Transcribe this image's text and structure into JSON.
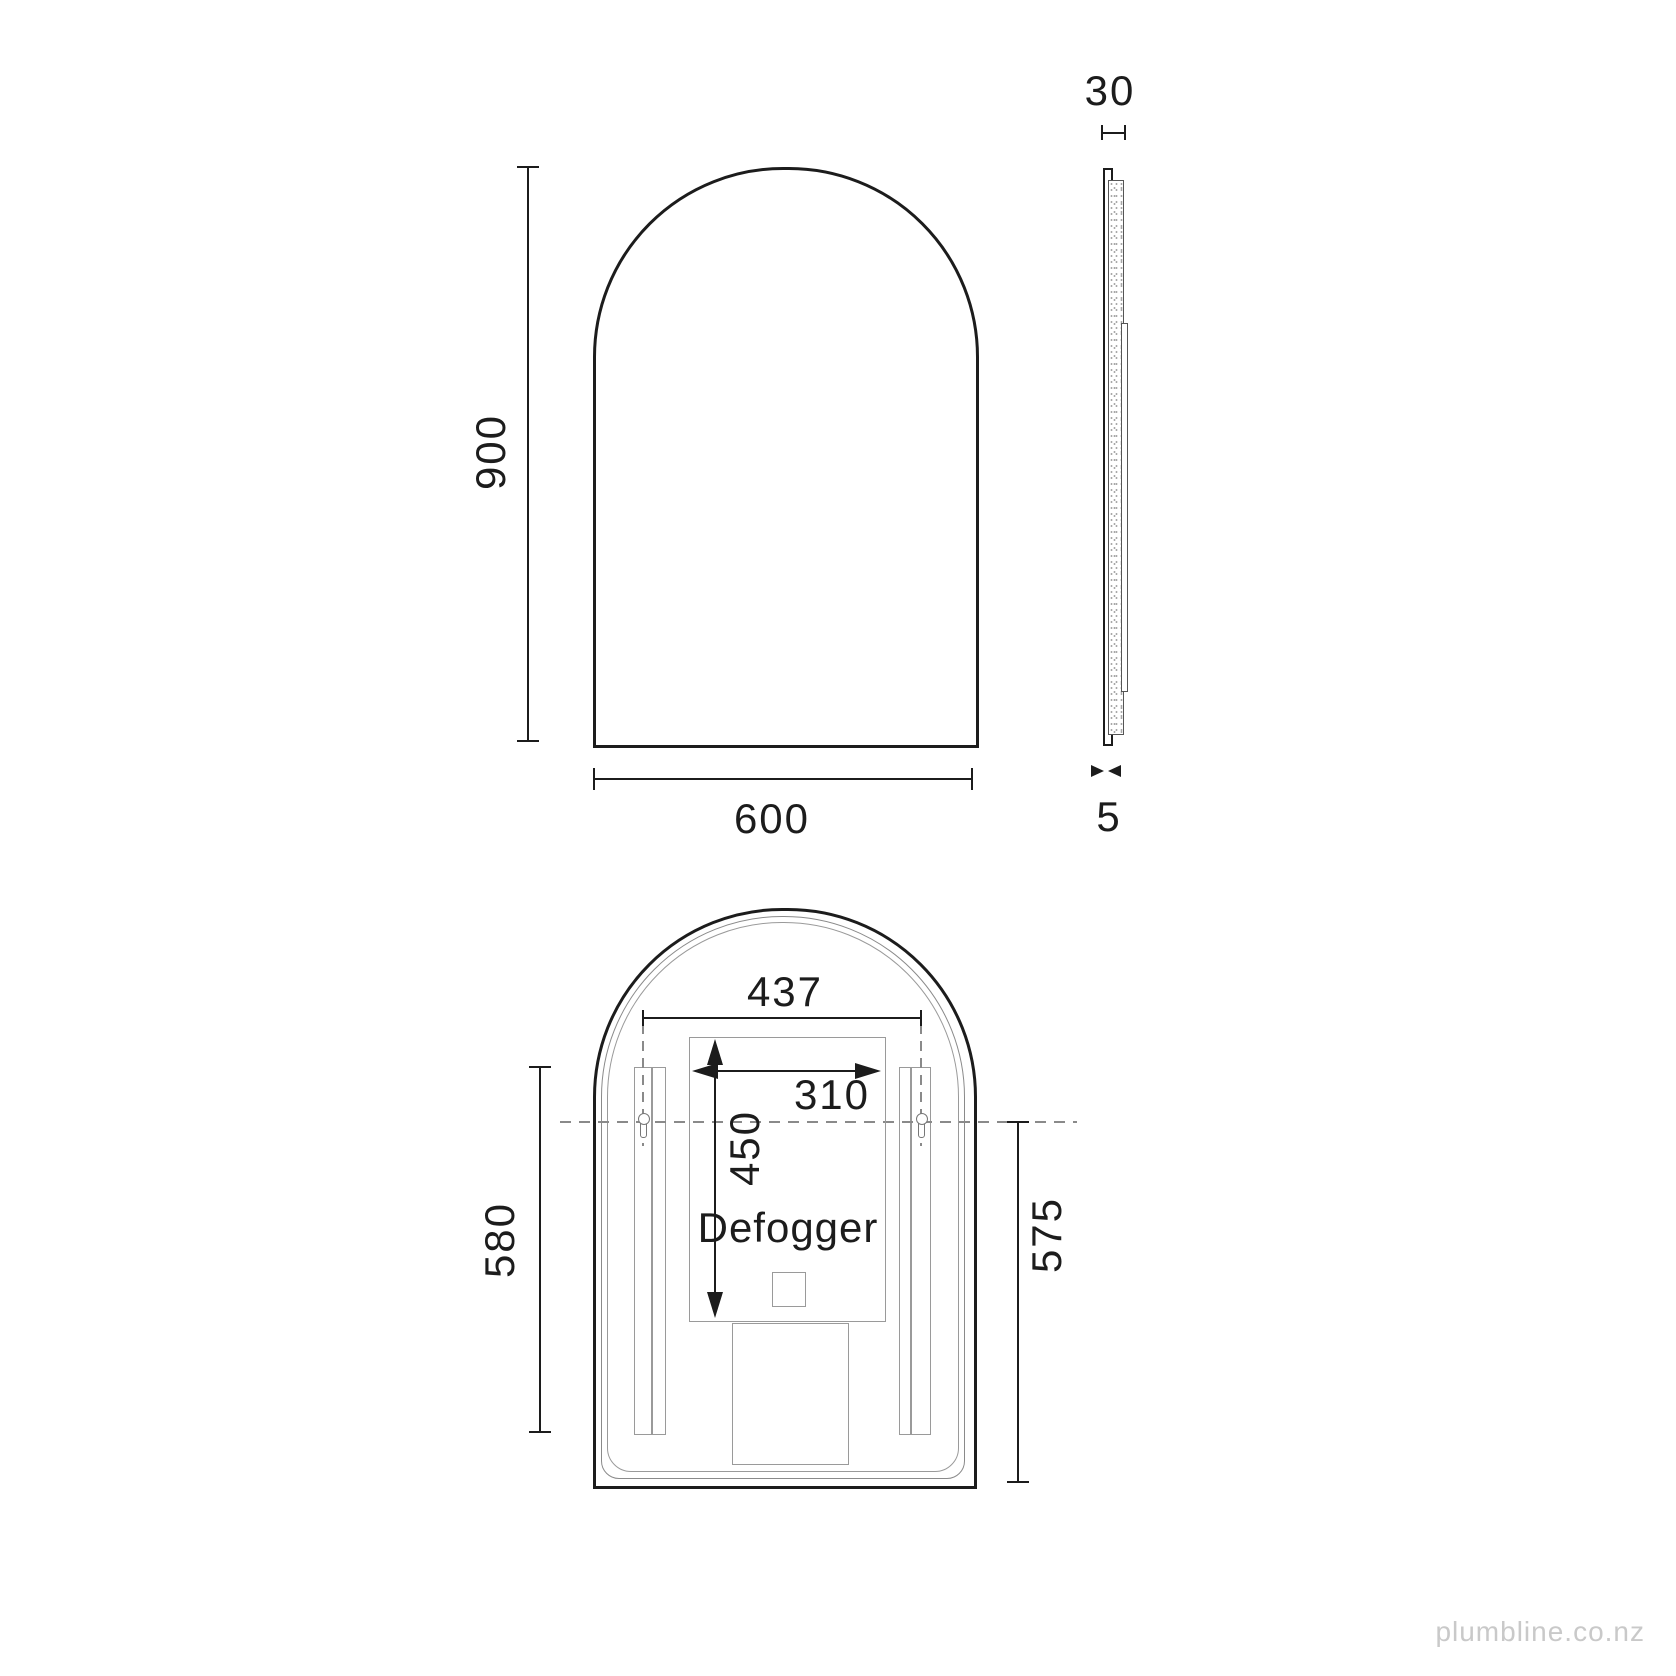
{
  "front_view": {
    "height": "900",
    "width": "600"
  },
  "side_view": {
    "depth": "30",
    "glass_thickness": "5"
  },
  "rear_view": {
    "mounting_width": "437",
    "defogger_width": "310",
    "defogger_height": "450",
    "defogger_label": "Defogger",
    "bracket_length": "580",
    "mounting_height": "575"
  },
  "watermark": "plumbline.co.nz",
  "colors": {
    "line": "#1c1c1c",
    "detail": "#8a8a8a",
    "watermark": "#c9c9c9"
  }
}
